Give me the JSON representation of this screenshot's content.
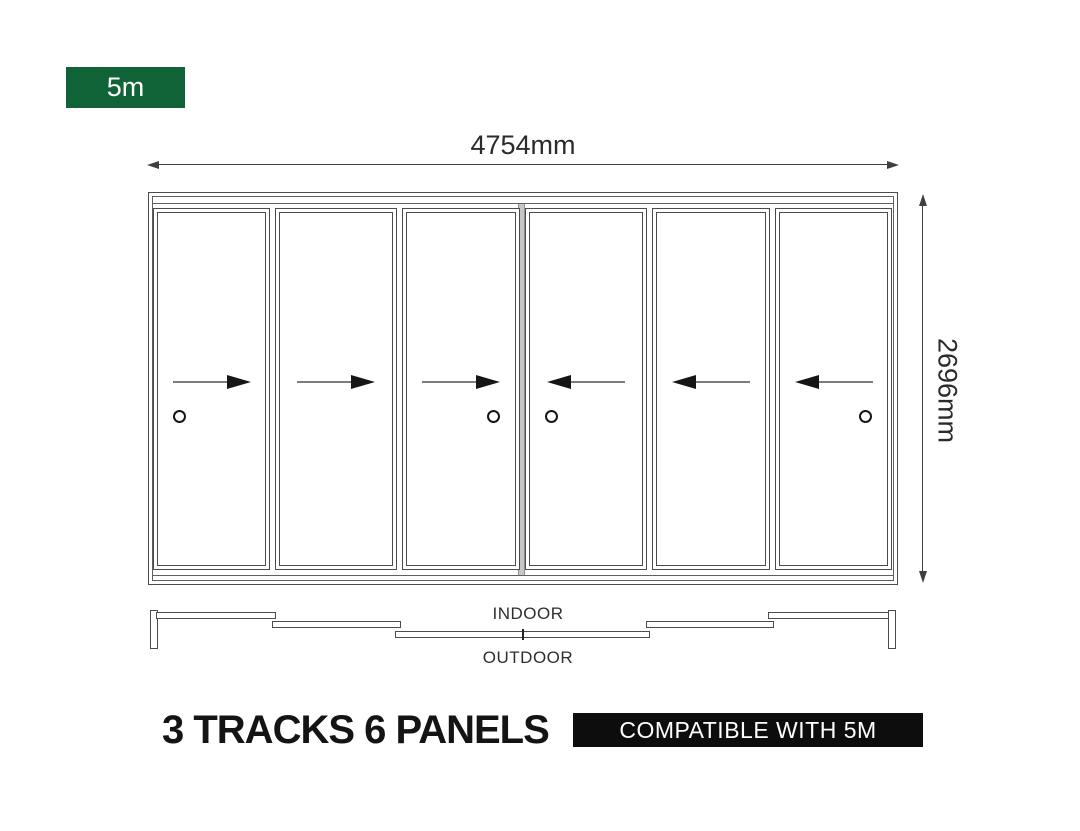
{
  "size_badge": {
    "label": "5m",
    "bg": "#106337",
    "text_color": "#ffffff"
  },
  "dimensions": {
    "width": "4754mm",
    "height": "2696mm"
  },
  "elevation": {
    "panels": [
      {
        "name": "panel-1",
        "arrow": "right",
        "handle": "left"
      },
      {
        "name": "panel-2",
        "arrow": "right",
        "handle": null
      },
      {
        "name": "panel-3",
        "arrow": "right",
        "handle": "right"
      },
      {
        "name": "panel-4",
        "arrow": "left",
        "handle": "left"
      },
      {
        "name": "panel-5",
        "arrow": "left",
        "handle": null
      },
      {
        "name": "panel-6",
        "arrow": "left",
        "handle": "right"
      }
    ]
  },
  "plan": {
    "indoor_label": "INDOOR",
    "outdoor_label": "OUTDOOR"
  },
  "footer": {
    "title": "3 TRACKS 6 PANELS",
    "compatibility_label": "COMPATIBLE WITH 5M",
    "badge_bg": "#0d0d0d"
  }
}
